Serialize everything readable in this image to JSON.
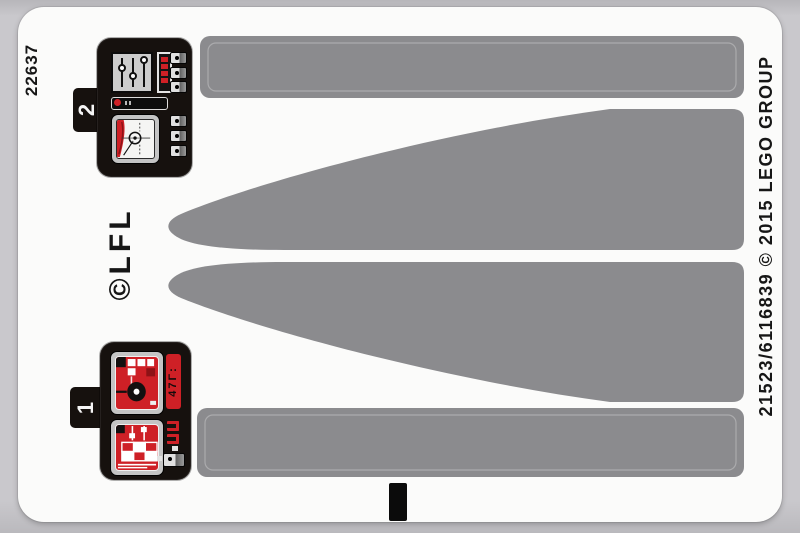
{
  "sheet": {
    "part_number": "22637",
    "lfl_copyright": "©LFL",
    "edge_text": "21523/6116839 © 2015 LEGO GROUP"
  },
  "stickers": {
    "panel_2": {
      "tab_label": "2"
    },
    "panel_1": {
      "tab_label": "1",
      "display_glyphs": "47Γ:"
    },
    "shape_names": [
      "strip-sticker-top",
      "wedge-sticker-upper",
      "wedge-sticker-lower",
      "strip-sticker-bottom",
      "black-bar-sticker"
    ]
  },
  "colors": {
    "background": "#c9c8cc",
    "sheet_white": "#fbfbfa",
    "sticker_gray": "#8b8b8e",
    "panel_black": "#16110e",
    "lego_red": "#ce2026",
    "frame_silver": "#c4c4c4",
    "text_black": "#161616",
    "label_white": "#f5f5f5"
  }
}
